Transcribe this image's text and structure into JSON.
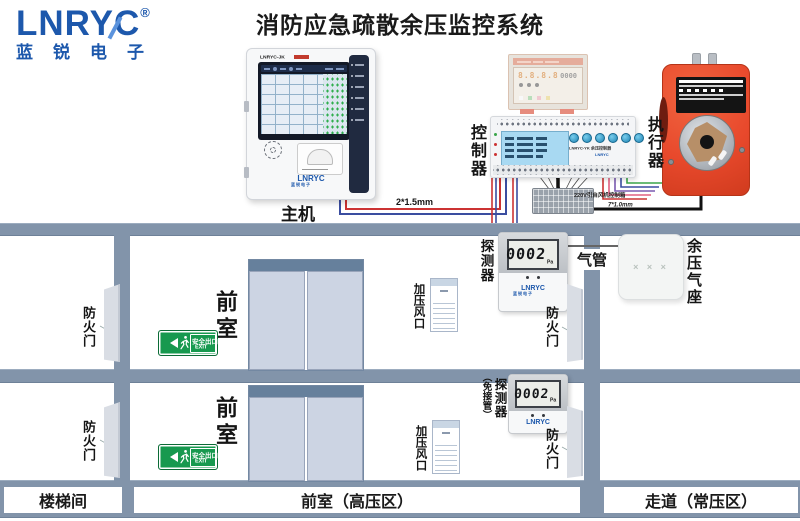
{
  "logo": {
    "brand": "LNRYC",
    "reg": "®",
    "subtitle": "蓝锐电子"
  },
  "title": "消防应急疏散余压监控系统",
  "host": {
    "label": "主机",
    "model": "LNRYC-JK",
    "brand": "LNRYC",
    "brand_sub": "蓝锐电子"
  },
  "controller": {
    "label": "控制器",
    "model": "LNRYC-YK 余压控制器",
    "brand": "LNRYC"
  },
  "actuator": {
    "label": "执行器"
  },
  "detector1": {
    "label": "探测器",
    "reading": "0002",
    "unit": "Pa",
    "brand": "LNRYC",
    "brand_sub": "蓝锐电子"
  },
  "detector2": {
    "label": "探测器",
    "note": "（免接管）",
    "reading": "0002",
    "unit": "Pa",
    "brand": "LNRYC"
  },
  "air_seat": {
    "label": "余压气座",
    "marks": "× × ×"
  },
  "tube_label": "气管",
  "wiring": {
    "host_cable": "2*1.5mm",
    "power_note": "220V引自风机控制箱",
    "actuator_cable": "7*1.0mm"
  },
  "floorplan": {
    "fire_door": "防火门",
    "anteroom": "前室",
    "vent": "加压风口",
    "exit_cn": "安全出口",
    "exit_en": "EXIT",
    "legend_stairwell": "楼梯间",
    "legend_anteroom": "前室（高压区）",
    "legend_corridor": "走道（常压区）"
  },
  "colors": {
    "brand_blue": "#1d58ac",
    "exit_green": "#17994f",
    "actuator_orange": "#e8492c",
    "wall_gray": "#8294aa",
    "wire_red": "#cc3333",
    "wire_blue": "#3a4da0"
  }
}
